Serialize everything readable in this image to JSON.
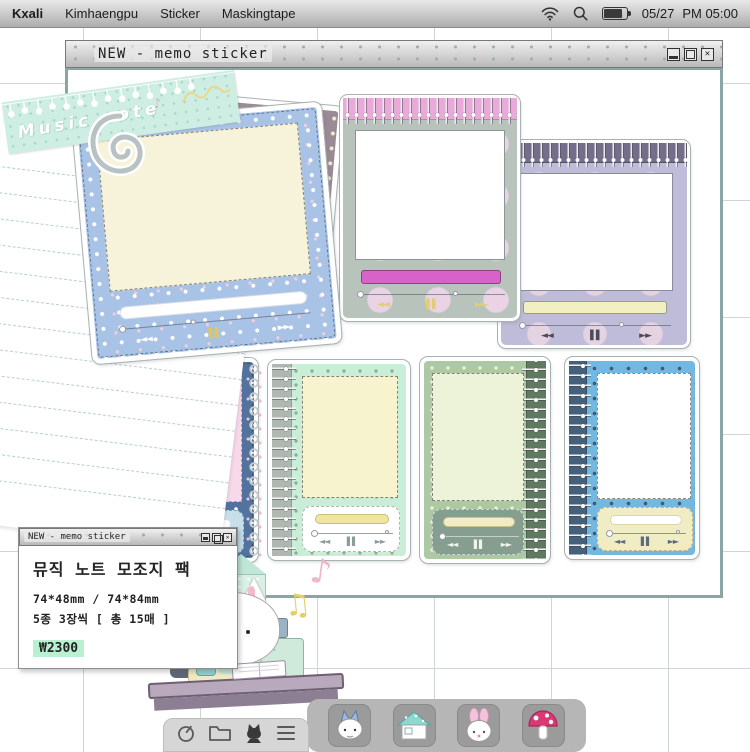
{
  "menu_bar": {
    "brand": "Kxali",
    "items": [
      "Kimhaengpu",
      "Sticker",
      "Maskingtape"
    ],
    "date": "05/27",
    "time": "PM 05:00"
  },
  "main_window": {
    "title": "NEW - memo sticker",
    "close_glyph": "✕"
  },
  "info_window": {
    "title": "NEW - memo sticker",
    "close_glyph": "✕",
    "product_name": "뮤직 노트 모조지 팩",
    "sizes": "74*48mm / 74*84mm",
    "pack_info": "5종 3장씩 [ 총 15매 ]",
    "price": "₩2300"
  },
  "washi_tape": {
    "text": "Music note"
  },
  "player": {
    "rewind": "◄◄",
    "pause": "▌▌",
    "forward": "►►"
  },
  "speech_bubble": {
    "note": "♪"
  },
  "floating_notes": {
    "pink": "♪",
    "yellow": "♫"
  },
  "colors": {
    "window_border": "#8ba4a4",
    "blue_sticker": "#a9c3e6",
    "mauve_sticker": "#9a8a95",
    "pink_binding": "#e9a9d9",
    "pink_progress": "#d763c9",
    "lavender_body": "#bfbcd9",
    "slate_blue": "#52739e",
    "mint_body": "#c9eed8",
    "sage_body": "#adc9a3",
    "sky_blue": "#73b8e1",
    "cream": "#f6f3da",
    "price_highlight": "#b9f0d2"
  }
}
